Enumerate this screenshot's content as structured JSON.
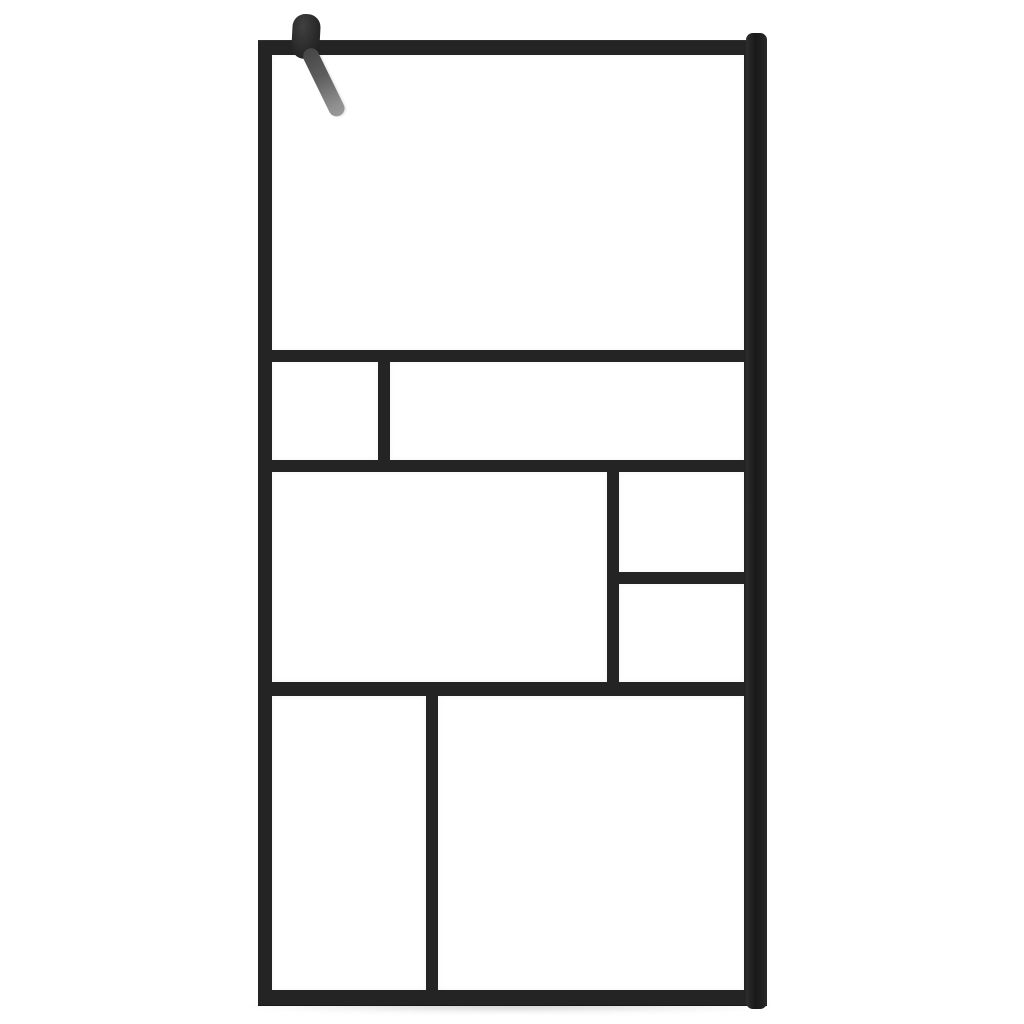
{
  "image": {
    "type": "product-photo",
    "subject": "Walk-in shower screen with clear tempered glass and black Mondrian-style grid frame",
    "details": "Tall rectangular black aluminium frame holding eight clear glass panes in an asymmetric grid; wall-mount channel profile along the right edge with rounded ends; black pivot clamp with angled grey stabiliser support arm at the top-left corner; plain white studio background"
  },
  "palette": {
    "background": "#ffffff",
    "frame": "#242424",
    "glass": "#ffffff",
    "wall_profile": "#1e1e1e",
    "clamp": "#2e2e2e",
    "arm_top": "#454545",
    "arm_bottom": "#9a9a9a",
    "shadow": "rgba(0,0,0,0.22)"
  },
  "screen": {
    "geom": {
      "x": 258,
      "y": 40,
      "w": 509,
      "h": 966
    },
    "panes": [
      {
        "id": "top",
        "x": 14,
        "y": 15,
        "w": 472,
        "h": 295
      },
      {
        "id": "row2-left",
        "x": 14,
        "y": 322,
        "w": 106,
        "h": 98
      },
      {
        "id": "row2-right",
        "x": 132,
        "y": 322,
        "w": 354,
        "h": 98
      },
      {
        "id": "row3-left",
        "x": 14,
        "y": 432,
        "w": 335,
        "h": 210
      },
      {
        "id": "row3-right-upper",
        "x": 361,
        "y": 432,
        "w": 125,
        "h": 100
      },
      {
        "id": "row3-right-lower",
        "x": 361,
        "y": 544,
        "w": 125,
        "h": 98
      },
      {
        "id": "row4-left",
        "x": 14,
        "y": 656,
        "w": 154,
        "h": 294
      },
      {
        "id": "row4-right",
        "x": 180,
        "y": 656,
        "w": 306,
        "h": 294
      }
    ]
  },
  "wall_profile": {
    "geom": {
      "x": 746,
      "y": 33,
      "w": 21,
      "h": 976
    }
  },
  "bracket": {
    "clamp": {
      "geom": {
        "x": 292,
        "y": 14,
        "w": 28,
        "h": 45,
        "angle_deg": 3
      }
    },
    "arm": {
      "geom": {
        "x": 304,
        "y": 48,
        "w": 16,
        "h": 74,
        "angle_deg": -26
      }
    }
  },
  "floor_shadow": {
    "geom": {
      "x": 250,
      "y": 1000,
      "w": 522,
      "h": 12
    }
  }
}
